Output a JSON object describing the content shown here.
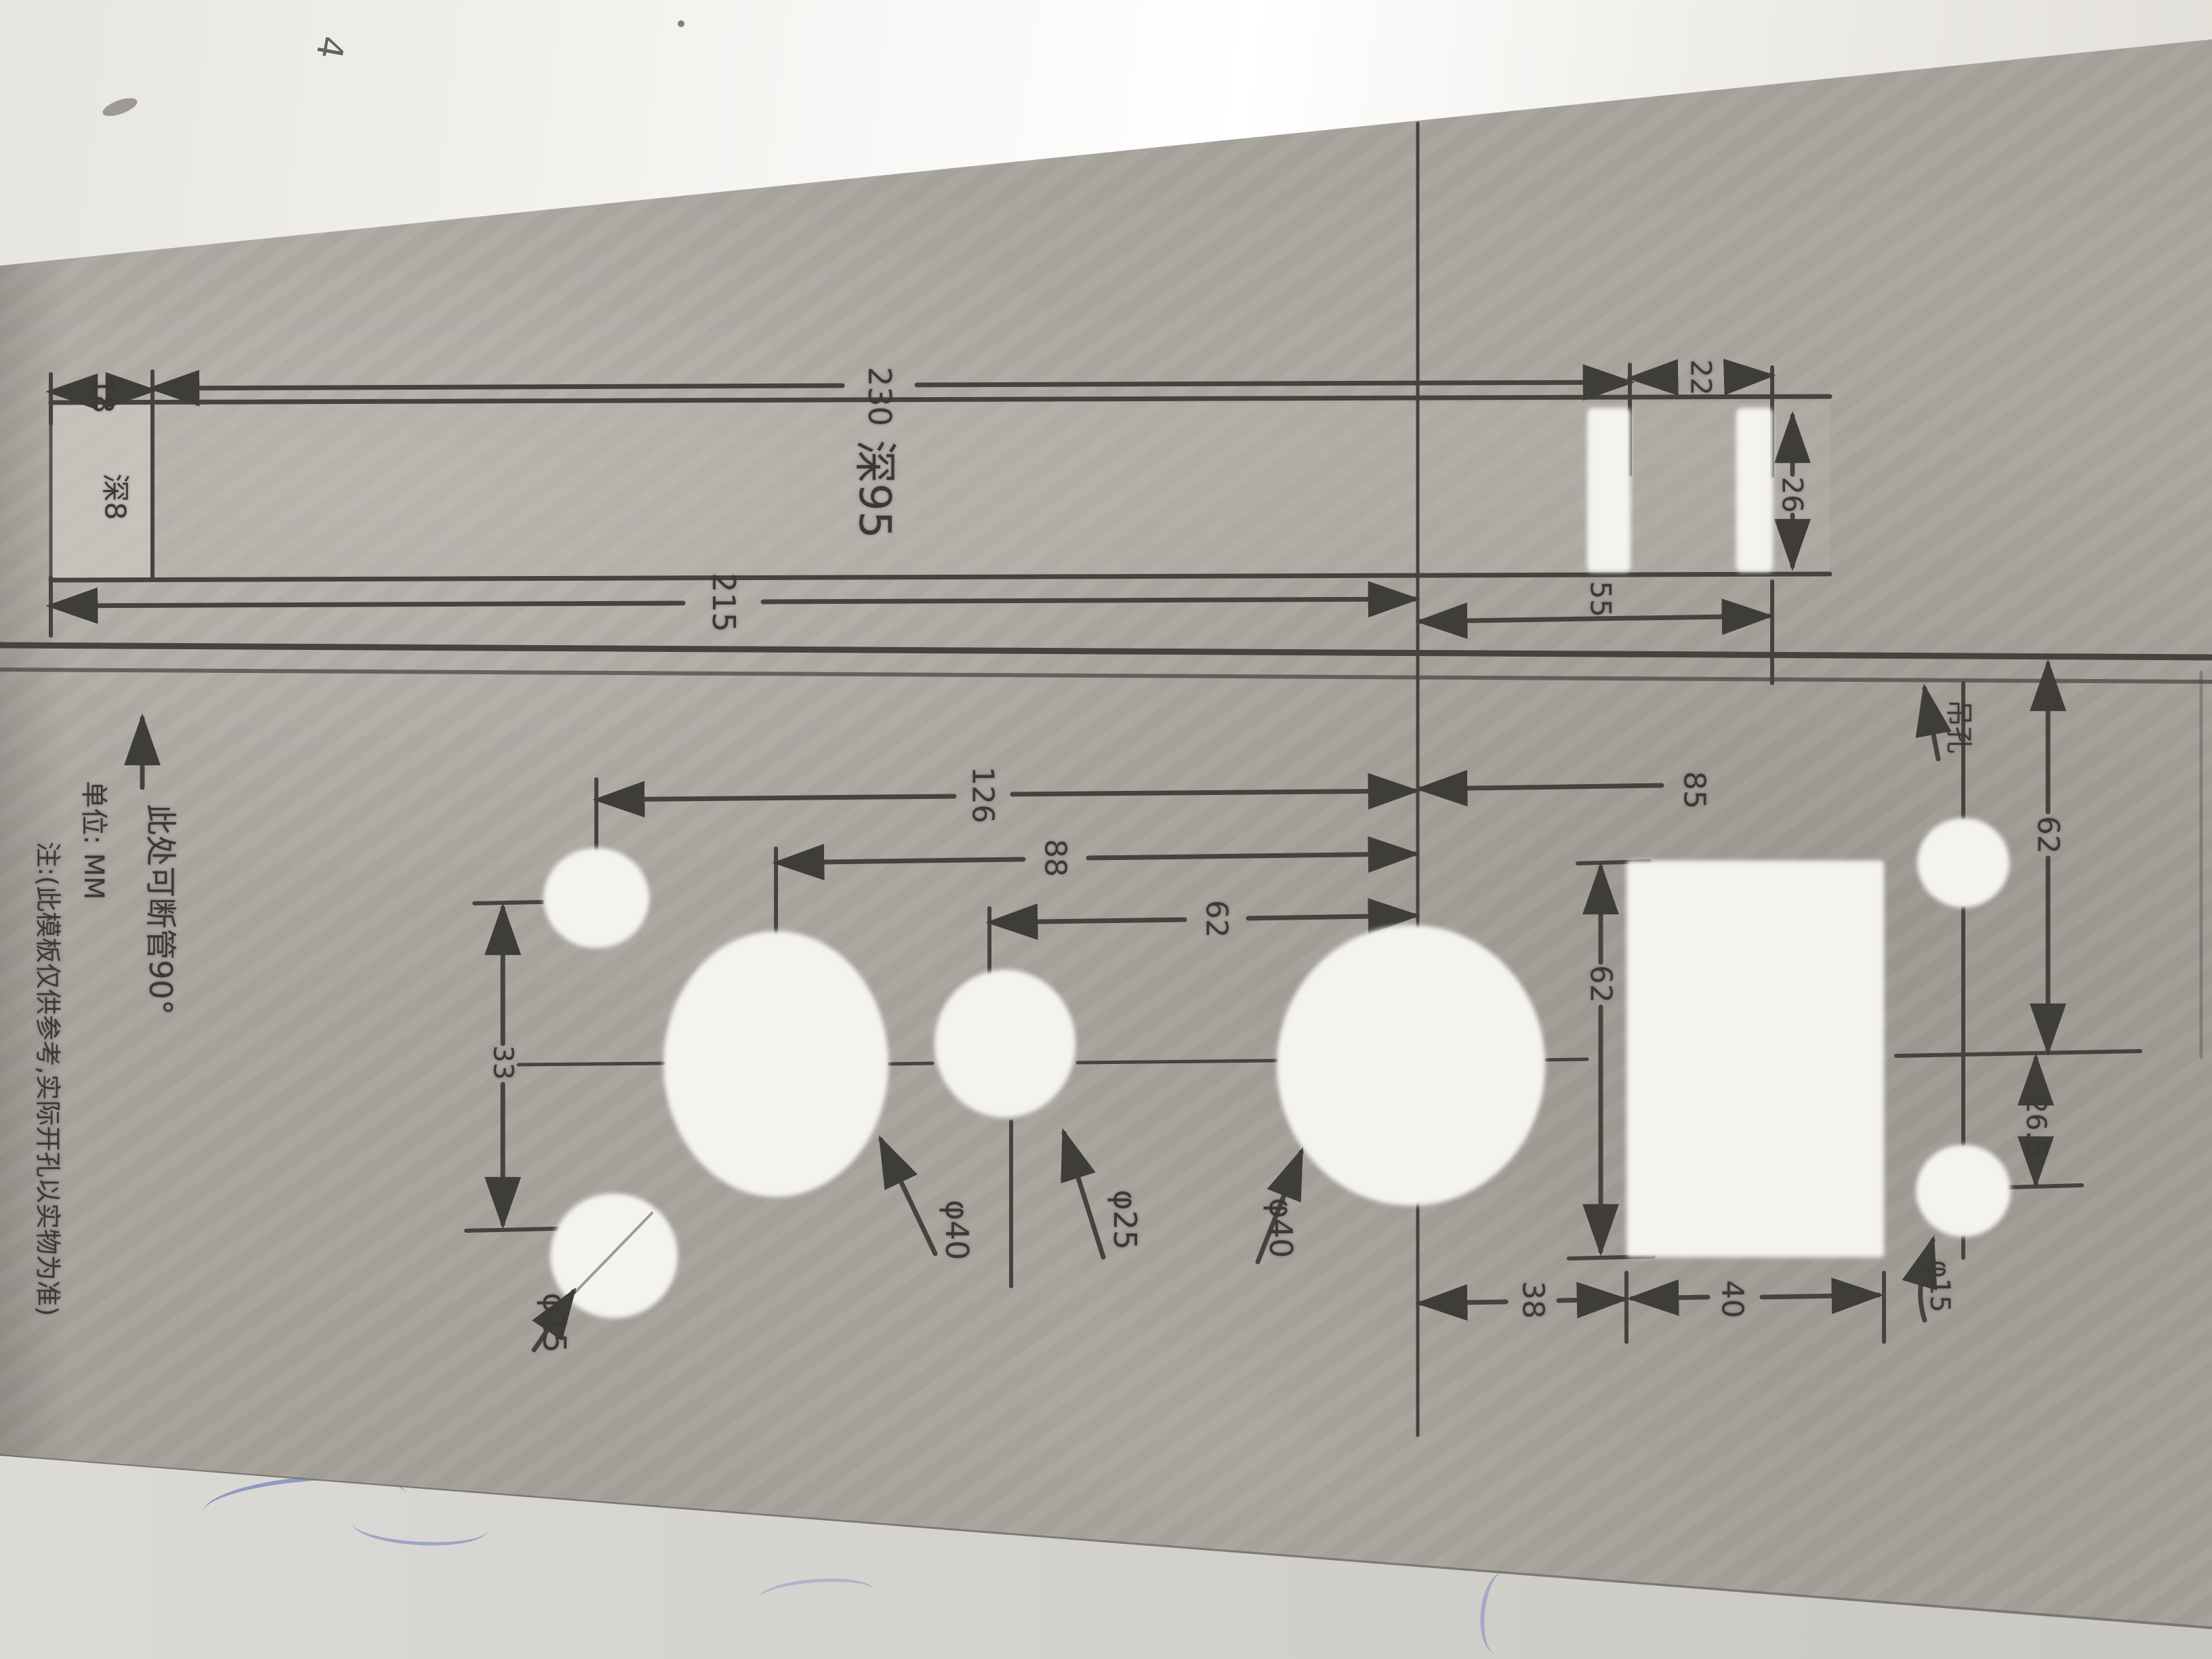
{
  "colors": {
    "sheet": "#aeaaa3",
    "ink": "#45433e",
    "hole_fill": "#f4f3ef",
    "pen_blue": "rgba(70,90,180,0.5)"
  },
  "annotations": {
    "direction_note": "此处可断管90°",
    "unit_note": "单位: MM",
    "disclaimer_note": "注:(此模板仅供参考,实际开孔以实物为准)",
    "pencil_mark": "4"
  },
  "band": {
    "depth": "深95",
    "cap_depth": "深8",
    "dims": {
      "left_cap": "18",
      "width_total": "230",
      "slot_gap": "22",
      "slot_height": "26",
      "offset_right": "55",
      "overall": "215"
    }
  },
  "holes": {
    "left_small_bottom": "φ15",
    "left_big": "φ40",
    "middle": "φ25",
    "right_big": "φ40",
    "right_small_bottom": "φ15",
    "right_small_top": "吊孔"
  },
  "dims": {
    "left_col_to_center": "126",
    "big_left_to_center": "88",
    "mid_to_center": "62",
    "center_to_right_col": "85",
    "left_pair_gap": "33",
    "rect_height": "62",
    "center_to_rect": "38",
    "rect_width": "40",
    "right_top_span": "62",
    "right_circle_offset": "26.5"
  }
}
